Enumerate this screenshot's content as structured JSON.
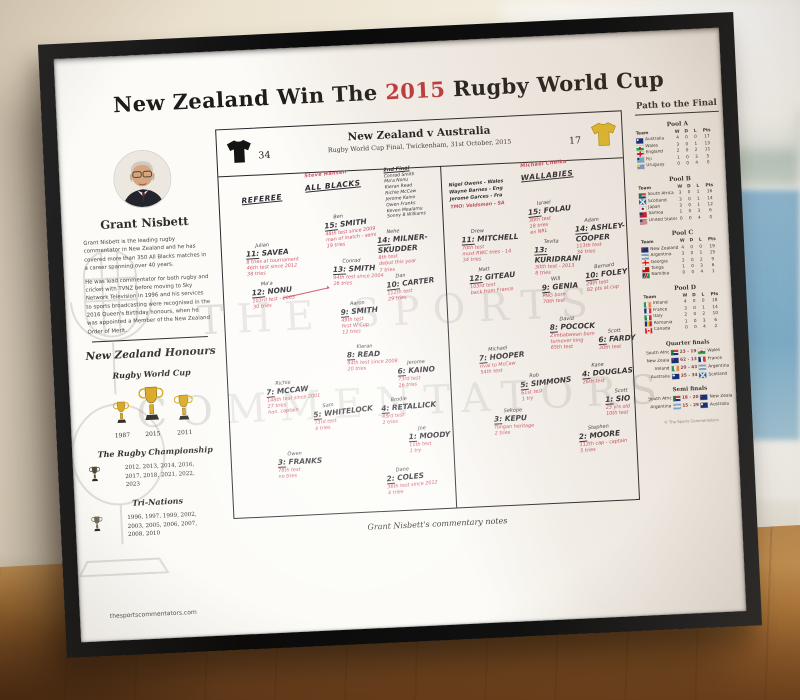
{
  "poster": {
    "title": {
      "prefix": "New Zealand Win The ",
      "year": "2015",
      "suffix": " Rugby World Cup"
    },
    "match_header": {
      "teams": "New Zealand v Australia",
      "detail": "Rugby World Cup Final, Twickenham, 31st October, 2015"
    },
    "score": {
      "home": "34",
      "away": "17"
    },
    "watermark_line1": "THE SPORTS",
    "watermark_line2": "COMMENTATORS",
    "caption": "Grant Nisbett's commentary notes",
    "website": "thesportscommentators.com"
  },
  "commentator": {
    "name": "Grant Nisbett",
    "bio": [
      "Grant Nisbett is the leading rugby commentator in New Zealand and he has covered more than 350 All Blacks matches in a career spanning over 40 years.",
      "He was lead commentator for both rugby and cricket with TVNZ before moving to Sky Network Television in 1996 and his services to sports broadcasting were recognised in the 2016 Queen's Birthday honours, when he was appointed a Member of the New Zealand Order of Merit."
    ]
  },
  "honours": {
    "heading": "New Zealand Honours",
    "rwc": {
      "title": "Rugby World Cup",
      "years": [
        "1987",
        "2015",
        "2011"
      ]
    },
    "championship": {
      "title": "The Rugby Championship",
      "years": "2012, 2013, 2014, 2016, 2017, 2018, 2021, 2022, 2023"
    },
    "tri_nations": {
      "title": "Tri-Nations",
      "years": "1996, 1997, 1999, 2002, 2003, 2005, 2006, 2007, 2008, 2010"
    }
  },
  "notes": {
    "referee_label": "Referee",
    "officials": [
      {
        "text": "Nigel Owens - Wales",
        "ink": "black"
      },
      {
        "text": "Wayne Barnes - Eng",
        "ink": "black"
      },
      {
        "text": "Jerome Garces - Fra",
        "ink": "black"
      },
      {
        "text": "TMO: Veldsman - SA",
        "ink": "red"
      }
    ],
    "all_blacks": {
      "coach": "Steve Hansen",
      "heading": "All Blacks",
      "second_final": {
        "label": "2nd Final",
        "names": [
          "Conrad Smith",
          "Ma'a Nonu",
          "Kieran Read",
          "Richie McCaw",
          "Jerome Kaino",
          "Owen Franks",
          "Keven Mealamu",
          "Sonny B Williams"
        ]
      },
      "players": [
        {
          "num": "15",
          "first": "Ben",
          "name": "Smith",
          "notes": [
            "48th test since 2009",
            "man of match - semi",
            "19 tries"
          ]
        },
        {
          "num": "14",
          "first": "Nehe",
          "name": "Milner-Skudder",
          "notes": [
            "8th test",
            "debut this year",
            "7 tries"
          ]
        },
        {
          "num": "13",
          "first": "Conrad",
          "name": "Smith",
          "notes": [
            "94th test since 2004",
            "26 tries"
          ]
        },
        {
          "num": "12",
          "first": "Ma'a",
          "name": "Nonu",
          "notes": [
            "103rd test - 2003",
            "30 tries"
          ]
        },
        {
          "num": "11",
          "first": "Julian",
          "name": "Savea",
          "notes": [
            "8 tries at tournament",
            "46th test since 2012",
            "38 tries"
          ]
        },
        {
          "num": "10",
          "first": "Dan",
          "name": "Carter",
          "notes": [
            "112th test",
            "29 tries"
          ]
        },
        {
          "num": "9",
          "first": "Aaron",
          "name": "Smith",
          "notes": [
            "49th test",
            "first W Cup",
            "12 tries"
          ]
        },
        {
          "num": "8",
          "first": "Kieran",
          "name": "Read",
          "notes": [
            "84th test since 2008",
            "20 tries"
          ]
        },
        {
          "num": "7",
          "first": "Richie",
          "name": "McCaw",
          "notes": [
            "148th test since 2001",
            "27 tries",
            "hon. captain"
          ]
        },
        {
          "num": "6",
          "first": "Jerome",
          "name": "Kaino",
          "notes": [
            "73rd test",
            "16 tries"
          ]
        },
        {
          "num": "5",
          "first": "Sam",
          "name": "Whitelock",
          "notes": [
            "73rd test",
            "4 tries"
          ]
        },
        {
          "num": "4",
          "first": "Brodie",
          "name": "Retallick",
          "notes": [
            "43rd test",
            "2 tries"
          ]
        },
        {
          "num": "3",
          "first": "Owen",
          "name": "Franks",
          "notes": [
            "78th test",
            "no tries"
          ]
        },
        {
          "num": "2",
          "first": "Dane",
          "name": "Coles",
          "notes": [
            "36th test since 2012",
            "4 tries"
          ]
        },
        {
          "num": "1",
          "first": "Joe",
          "name": "Moody",
          "notes": [
            "11th test",
            "1 try"
          ]
        }
      ]
    },
    "wallabies": {
      "coach": "Michael Cheika",
      "heading": "Wallabies",
      "players": [
        {
          "num": "15",
          "first": "Israel",
          "name": "Folau",
          "notes": [
            "30th test",
            "18 tries",
            "ex NRL"
          ]
        },
        {
          "num": "14",
          "first": "Adam",
          "name": "Ashley-Cooper",
          "notes": [
            "113th test",
            "34 tries"
          ]
        },
        {
          "num": "13",
          "first": "Tevita",
          "name": "Kuridrani",
          "notes": [
            "30th test - 2013",
            "8 tries"
          ]
        },
        {
          "num": "12",
          "first": "Matt",
          "name": "Giteau",
          "notes": [
            "103rd test",
            "back from France"
          ]
        },
        {
          "num": "11",
          "first": "Drew",
          "name": "Mitchell",
          "notes": [
            "70th test",
            "most RWC tries - 14",
            "34 tries"
          ]
        },
        {
          "num": "10",
          "first": "Bernard",
          "name": "Foley",
          "notes": [
            "29th test",
            "82 pts at cup"
          ]
        },
        {
          "num": "9",
          "first": "Will",
          "name": "Genia",
          "notes": [
            "PNG born",
            "70th test"
          ]
        },
        {
          "num": "8",
          "first": "David",
          "name": "Pocock",
          "notes": [
            "Zimbabwean born",
            "turnover king",
            "65th test"
          ]
        },
        {
          "num": "7",
          "first": "Michael",
          "name": "Hooper",
          "notes": [
            "rival to McCaw",
            "54th test"
          ]
        },
        {
          "num": "6",
          "first": "Scott",
          "name": "Fardy",
          "notes": [
            "30th test"
          ]
        },
        {
          "num": "5",
          "first": "Rob",
          "name": "Simmons",
          "notes": [
            "61st test",
            "1 try"
          ]
        },
        {
          "num": "4",
          "first": "Kane",
          "name": "Douglas",
          "notes": [
            "26th test"
          ]
        },
        {
          "num": "3",
          "first": "Sekope",
          "name": "Kepu",
          "notes": [
            "Tongan heritage",
            "2 tries"
          ]
        },
        {
          "num": "2",
          "first": "Stephen",
          "name": "Moore",
          "notes": [
            "112th cap - captain",
            "5 tries"
          ]
        },
        {
          "num": "1",
          "first": "Scott",
          "name": "Sio",
          "notes": [
            "23 yrs old",
            "10th test"
          ]
        }
      ]
    }
  },
  "path_to_final": {
    "heading": "Path to the Final",
    "team_label": "Team",
    "cols": [
      "W",
      "D",
      "L",
      "Pts"
    ],
    "pools": [
      {
        "name": "Pool A",
        "rows": [
          [
            "Australia",
            4,
            0,
            0,
            17
          ],
          [
            "Wales",
            3,
            0,
            1,
            13
          ],
          [
            "England",
            2,
            0,
            2,
            11
          ],
          [
            "Fiji",
            1,
            0,
            3,
            5
          ],
          [
            "Uruguay",
            0,
            0,
            4,
            0
          ]
        ]
      },
      {
        "name": "Pool B",
        "rows": [
          [
            "South Africa",
            3,
            0,
            1,
            16
          ],
          [
            "Scotland",
            3,
            0,
            1,
            14
          ],
          [
            "Japan",
            3,
            0,
            1,
            12
          ],
          [
            "Samoa",
            1,
            0,
            3,
            6
          ],
          [
            "United States",
            0,
            0,
            4,
            0
          ]
        ]
      },
      {
        "name": "Pool C",
        "rows": [
          [
            "New Zealand",
            4,
            0,
            0,
            19
          ],
          [
            "Argentina",
            3,
            0,
            1,
            15
          ],
          [
            "Georgia",
            2,
            0,
            2,
            9
          ],
          [
            "Tonga",
            1,
            0,
            3,
            6
          ],
          [
            "Namibia",
            0,
            0,
            4,
            1
          ]
        ]
      },
      {
        "name": "Pool D",
        "rows": [
          [
            "Ireland",
            4,
            0,
            0,
            18
          ],
          [
            "France",
            3,
            0,
            1,
            14
          ],
          [
            "Italy",
            2,
            0,
            2,
            10
          ],
          [
            "Romania",
            1,
            0,
            3,
            6
          ],
          [
            "Canada",
            0,
            0,
            4,
            2
          ]
        ]
      }
    ],
    "knockouts": [
      {
        "name": "Quarter finals",
        "rows": [
          [
            "South Africa",
            "23 - 19",
            "Wales"
          ],
          [
            "New Zealand",
            "62 - 13",
            "France"
          ],
          [
            "Ireland",
            "20 - 43",
            "Argentina"
          ],
          [
            "Australia",
            "35 - 34",
            "Scotland"
          ]
        ]
      },
      {
        "name": "Semi finals",
        "rows": [
          [
            "South Africa",
            "18 - 20",
            "New Zealand"
          ],
          [
            "Argentina",
            "15 - 29",
            "Australia"
          ]
        ]
      }
    ],
    "copyright": "© The Sports Commentators"
  }
}
